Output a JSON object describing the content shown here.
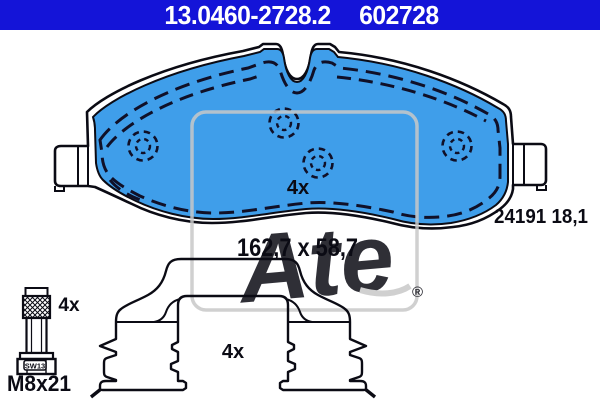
{
  "header": {
    "part_number": "13.0460-2728.2",
    "ref_number": "602728",
    "bg_color": "#1414D8",
    "text_color": "#FFFFFF"
  },
  "pad": {
    "quantity_label": "4x",
    "dimensions_label": "162,7 x 58,7",
    "wva_label": "24191 18,1",
    "fill_color": "#3F9EEA",
    "outline_color": "#0B0B14",
    "chamfer_line_color": "#101028"
  },
  "bolt": {
    "quantity_label": "4x",
    "thread_label": "M8x21",
    "head_label": "SW13"
  },
  "clip": {
    "quantity_label": "4x"
  },
  "watermark": {
    "brand": "Ate",
    "registered": "®",
    "color": "#C8C8C8"
  }
}
